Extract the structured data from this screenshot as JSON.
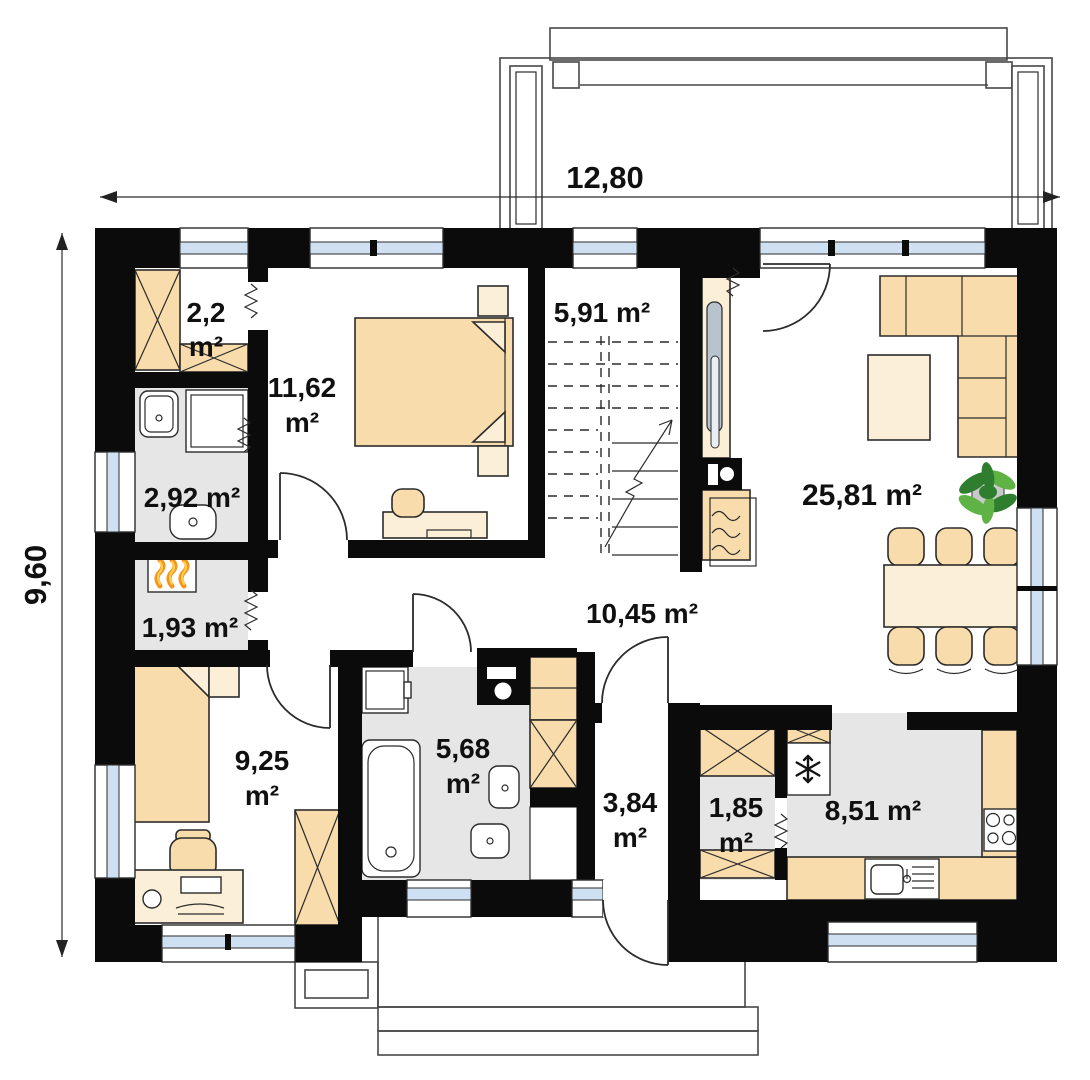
{
  "plan": {
    "type": "floor-plan",
    "dimensions": {
      "width_label": "12,80",
      "height_label": "9,60"
    },
    "rooms": [
      {
        "id": "wardrobe-closet",
        "lines": [
          "2,2",
          "m²"
        ]
      },
      {
        "id": "bedroom-upper",
        "lines": [
          "11,62",
          "m²"
        ]
      },
      {
        "id": "staircase",
        "lines": [
          "5,91 m²"
        ]
      },
      {
        "id": "bathroom-small",
        "lines": [
          "2,92 m²"
        ]
      },
      {
        "id": "boiler-room",
        "lines": [
          "1,93 m²"
        ]
      },
      {
        "id": "hall",
        "lines": [
          "10,45 m²"
        ]
      },
      {
        "id": "living-room",
        "lines": [
          "25,81 m²"
        ]
      },
      {
        "id": "bedroom-lower",
        "lines": [
          "9,25",
          "m²"
        ]
      },
      {
        "id": "bathroom-main",
        "lines": [
          "5,68",
          "m²"
        ]
      },
      {
        "id": "entry",
        "lines": [
          "3,84",
          "m²"
        ]
      },
      {
        "id": "pantry",
        "lines": [
          "1,85",
          "m²"
        ]
      },
      {
        "id": "kitchen",
        "lines": [
          "8,51 m²"
        ]
      }
    ],
    "colors": {
      "wall": "#0b0b0b",
      "line": "#2b2b2b",
      "floor_gray": "#e6e6e6",
      "furniture": "#f9dcab",
      "furniture_light": "#fcefd8",
      "glass": "#cfe0f2",
      "plant_dark": "#2f7d2f",
      "plant_light": "#5fb344",
      "flame": "#f7941d",
      "background": "#ffffff"
    }
  }
}
